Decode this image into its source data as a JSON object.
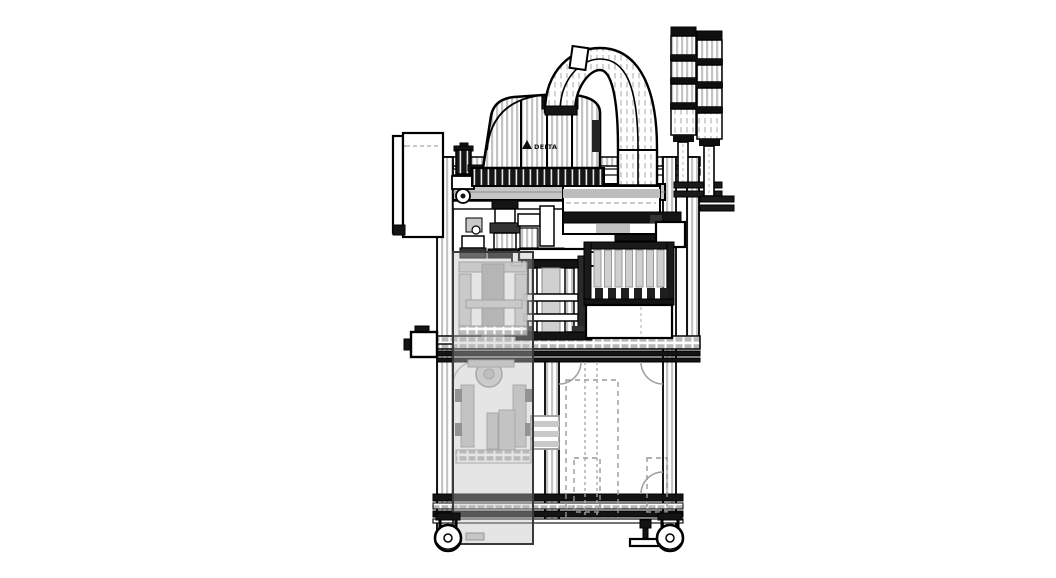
{
  "page": {
    "background_color": "#ffffff"
  },
  "drawing": {
    "type": "cad-side-elevation-line-drawing",
    "line_color": "#000000",
    "hatch_color": "#c4c4c4",
    "ghost_color": "#c8c8c8",
    "dark_fill_color": "#141414",
    "robot": {
      "logo_text": "DELTA"
    },
    "components": [
      "machine-frame",
      "aluminum-extrusion-posts",
      "work-table",
      "bottom-rails",
      "scara-robot-body",
      "robot-base-beam",
      "cable-carrier-arch",
      "signal-tower-left",
      "signal-tower-right",
      "monitor-panel",
      "pneumatic-frl-unit",
      "horizontal-linear-actuator",
      "end-effector-tooling",
      "press-station",
      "slat-feeder-magazine",
      "ghost-door-panel",
      "below-table-mechanism",
      "hidden-dashed-parts",
      "caster-wheel-left",
      "caster-wheel-right",
      "leveling-foot"
    ]
  }
}
